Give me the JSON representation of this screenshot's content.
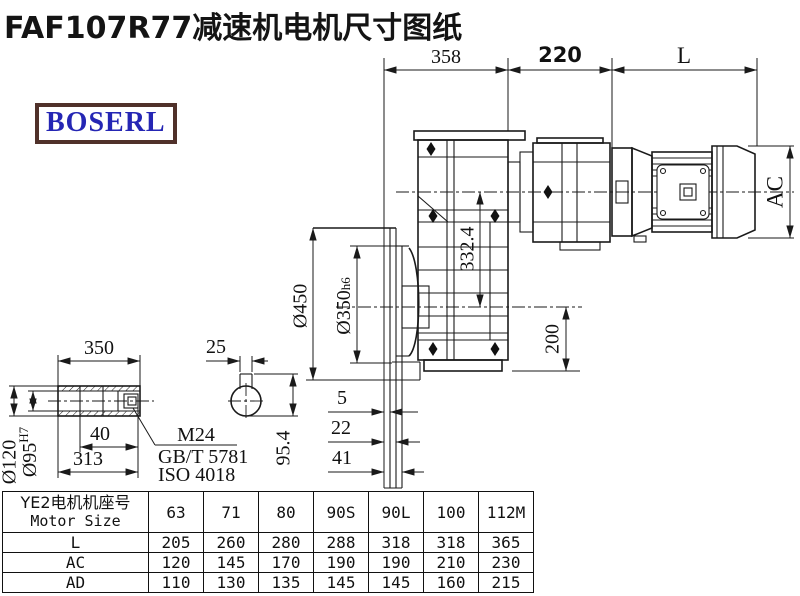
{
  "page": {
    "title": "FAF107R77减速机电机尺寸图纸"
  },
  "logo": {
    "text": "BOSERL",
    "border_color": "#50312a",
    "text_color": "#2526b4"
  },
  "drawing": {
    "top_dims": {
      "d358": "358",
      "d220": "220",
      "dL": "L"
    },
    "motor": {
      "ac": "AC"
    },
    "gearbox": {
      "d332": "332.4",
      "d200": "200",
      "dia450": "Ø450",
      "dia350": "Ø350",
      "dia350_suffix": "h6"
    },
    "flange": {
      "d5": "5",
      "d22": "22",
      "d41": "41"
    },
    "shaft": {
      "d350": "350",
      "d40": "40",
      "d313": "313",
      "dia120": "Ø120",
      "dia95": "Ø95",
      "dia95_sup": "H7",
      "m24": "M24",
      "gbt": "GB/T 5781",
      "iso": "ISO 4018"
    },
    "keyview": {
      "d25": "25",
      "d954": "95.4"
    }
  },
  "table": {
    "header_cn": "YE2电机机座号",
    "header_en": "Motor Size",
    "columns": [
      "63",
      "71",
      "80",
      "90S",
      "90L",
      "100",
      "112M"
    ],
    "rows": [
      {
        "label": "L",
        "values": [
          "205",
          "260",
          "280",
          "288",
          "318",
          "318",
          "365"
        ]
      },
      {
        "label": "AC",
        "values": [
          "120",
          "145",
          "170",
          "190",
          "190",
          "210",
          "230"
        ]
      },
      {
        "label": "AD",
        "values": [
          "110",
          "130",
          "135",
          "145",
          "145",
          "160",
          "215"
        ]
      }
    ]
  }
}
